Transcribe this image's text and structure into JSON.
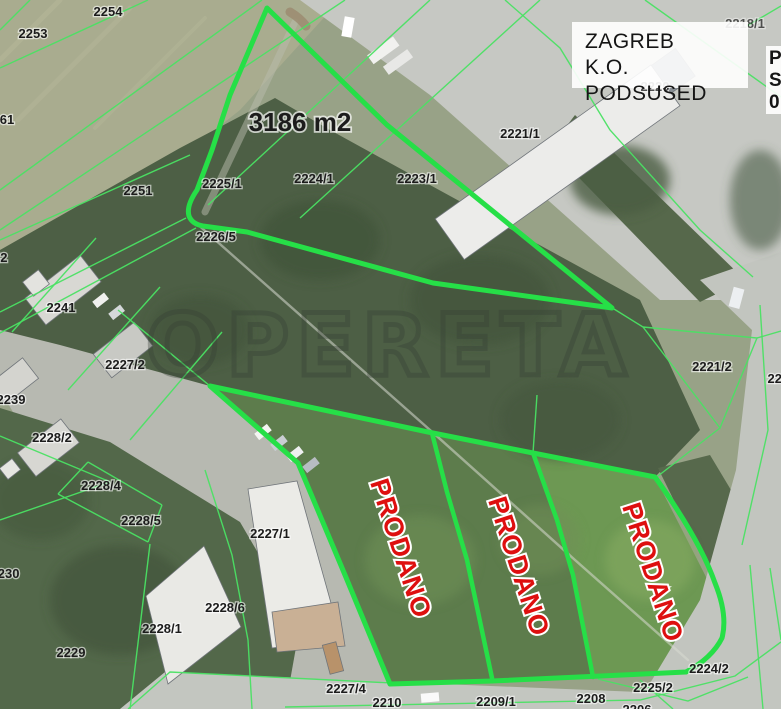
{
  "map": {
    "watermark": "OPERETA",
    "title_box": {
      "line1": "ZAGREB",
      "line2": "K.O. PODSUSED"
    },
    "partial_box": {
      "lines": [
        "P",
        "S",
        "0"
      ]
    },
    "area_label": {
      "text": "3186 m2",
      "x": 300,
      "y": 131
    },
    "colors": {
      "boundary": "#26df47",
      "thin_line": "#4ae263",
      "sold_red": "#de0f0f",
      "label": "#1c1c1c",
      "label_halo": "rgba(255,255,255,0.6)"
    },
    "sold_labels": [
      {
        "text": "PRODANO",
        "x": 399,
        "y": 549,
        "rot": 72
      },
      {
        "text": "PRODANO",
        "x": 517,
        "y": 567,
        "rot": 72
      },
      {
        "text": "PRODANO",
        "x": 651,
        "y": 573,
        "rot": 72
      }
    ],
    "parcel_labels": [
      {
        "text": "2254",
        "x": 108,
        "y": 16
      },
      {
        "text": "2253",
        "x": 33,
        "y": 38
      },
      {
        "text": "61",
        "x": 7,
        "y": 124
      },
      {
        "text": "2218/1",
        "x": 745,
        "y": 28,
        "op": 0.7
      },
      {
        "text": "2220",
        "x": 655,
        "y": 91,
        "op": 0.75
      },
      {
        "text": "2251",
        "x": 138,
        "y": 195
      },
      {
        "text": "2225/1",
        "x": 222,
        "y": 188
      },
      {
        "text": "2224/1",
        "x": 314,
        "y": 183
      },
      {
        "text": "2223/1",
        "x": 417,
        "y": 183
      },
      {
        "text": "2221/1",
        "x": 520,
        "y": 138
      },
      {
        "text": "2226/5",
        "x": 216,
        "y": 241
      },
      {
        "text": "2242",
        "x": -7,
        "y": 262
      },
      {
        "text": "2241",
        "x": 61,
        "y": 312
      },
      {
        "text": "2227/2",
        "x": 125,
        "y": 369
      },
      {
        "text": "2239",
        "x": 11,
        "y": 404
      },
      {
        "text": "2228/2",
        "x": 52,
        "y": 442
      },
      {
        "text": "2228/4",
        "x": 101,
        "y": 490
      },
      {
        "text": "2228/5",
        "x": 141,
        "y": 525
      },
      {
        "text": "2230",
        "x": 5,
        "y": 578
      },
      {
        "text": "2228/6",
        "x": 225,
        "y": 612
      },
      {
        "text": "2228/1",
        "x": 162,
        "y": 633
      },
      {
        "text": "2229",
        "x": 71,
        "y": 657
      },
      {
        "text": "2227/1",
        "x": 270,
        "y": 538
      },
      {
        "text": "2221/2",
        "x": 712,
        "y": 371
      },
      {
        "text": "2222",
        "x": 782,
        "y": 383
      },
      {
        "text": "2224/2",
        "x": 709,
        "y": 673
      },
      {
        "text": "2225/2",
        "x": 653,
        "y": 692
      },
      {
        "text": "2227/4",
        "x": 346,
        "y": 693
      },
      {
        "text": "2210",
        "x": 387,
        "y": 707
      },
      {
        "text": "2209/1",
        "x": 496,
        "y": 706
      },
      {
        "text": "2208",
        "x": 591,
        "y": 703
      },
      {
        "text": "2206",
        "x": 637,
        "y": 714
      }
    ],
    "geometry": {
      "highlight_parcels": [
        {
          "name": "parcel-boundary-3186",
          "path": "M267,8 L230,95 L212,150 L197,190 Q186,206 189,216 Q192,224 203,226 L247,232 L433,283 L612,308 L387,125 Z"
        },
        {
          "name": "sold-area-boundary",
          "path": "M210,386 L428,432 L533,453 L655,477 Q700,540 715,583 Q728,615 722,638 Q712,658 686,672 L492,681 L390,684 L345,575 L298,463 Z"
        }
      ],
      "dividers": [
        "M432,433 L447,492 L467,560 L492,678",
        "M533,453 L557,520 L573,575 L593,677"
      ],
      "thin_lines": [
        "M30,0 L0,30",
        "M148,0 L0,68",
        "M262,0 L0,190",
        "M345,0 L0,230",
        "M430,0 L208,205",
        "M540,0 L300,218",
        "M0,240 L190,155",
        "M0,312 L186,218",
        "M196,228 L0,333",
        "M96,238 L12,332",
        "M160,287 L68,390",
        "M222,332 L130,440",
        "M118,310 L210,386",
        "M88,462 L162,505",
        "M58,494 L148,542",
        "M88,462 L58,494",
        "M162,505 L148,542",
        "M150,544 L130,709",
        "M205,470 L232,555 L248,640 L252,709",
        "M0,520 L110,482",
        "M0,436 L108,481",
        "M128,709 L170,672 L392,683",
        "M285,707 L640,700 L735,676 L781,642",
        "M598,679 L688,701 L748,677",
        "M640,680 L673,709",
        "M760,305 L768,430 L742,545",
        "M750,565 L763,709",
        "M770,568 L781,640",
        "M643,327 L757,338 L720,428 L643,327",
        "M643,327 L614,309",
        "M720,428 L658,476",
        "M757,338 L781,331",
        "M645,0 L781,97",
        "M505,0 L560,48 L610,130 L700,230 L753,277",
        "M781,6 L747,26",
        "M537,395 L533,453"
      ]
    }
  }
}
